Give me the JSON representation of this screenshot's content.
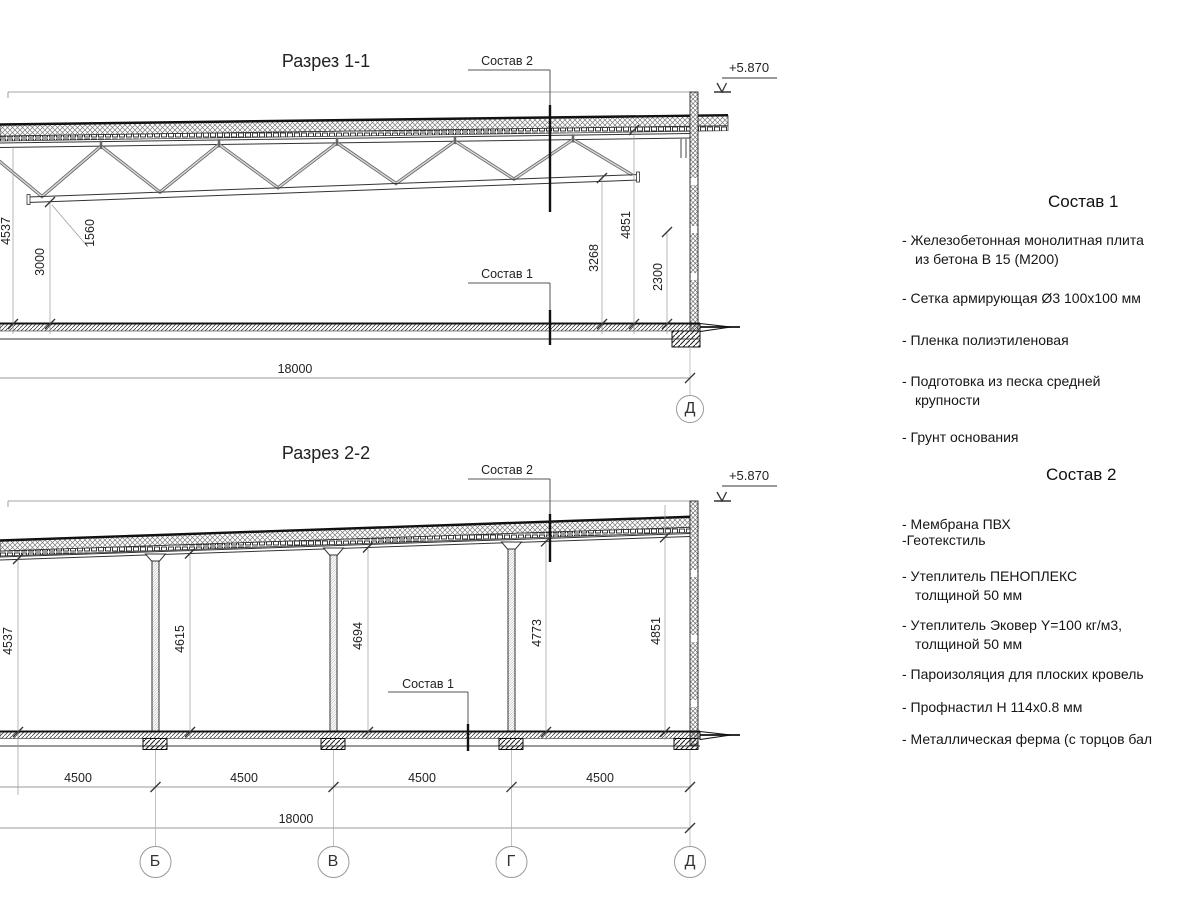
{
  "section_1": {
    "title": "Разрез 1-1",
    "composition_2_label": "Состав 2",
    "composition_1_label": "Состав 1",
    "elevation_mark": "+5.870",
    "dim_left_total": "4537",
    "dim_left_clear": "3000",
    "dim_truss_depth": "1560",
    "dim_right_roof": "4851",
    "dim_right_chord": "3268",
    "dim_right_panel": "2300",
    "dim_overall": "18000",
    "axis_label": "Д"
  },
  "section_2": {
    "title": "Разрез 2-2",
    "composition_2_label": "Состав 2",
    "composition_1_label": "Состав 1",
    "elevation_mark": "+5.870",
    "height_dims": [
      "4537",
      "4615",
      "4694",
      "4773",
      "4851"
    ],
    "bay_dims": [
      "4500",
      "4500",
      "4500",
      "4500"
    ],
    "dim_overall": "18000",
    "axis_labels": [
      "Б",
      "В",
      "Г",
      "Д"
    ]
  },
  "composition_1": {
    "heading": "Состав 1",
    "items": [
      {
        "line1": "- Железобетонная  монолитная плита",
        "line2": "из бетона В 15 (М200)"
      },
      {
        "line1": "- Сетка армирующая Ø3 100х100 мм",
        "line2": ""
      },
      {
        "line1": "- Пленка полиэтиленовая",
        "line2": ""
      },
      {
        "line1": "- Подготовка из песка средней",
        "line2": "крупности"
      },
      {
        "line1": "- Грунт основания",
        "line2": ""
      }
    ]
  },
  "composition_2": {
    "heading": "Состав 2",
    "items": [
      {
        "line1": "- Мембрана ПВХ",
        "line2": "-Геотекстиль"
      },
      {
        "line1": "- Утеплитель ПЕНОПЛЕКС",
        "line2": "толщиной 50 мм"
      },
      {
        "line1": "- Утеплитель Эковер Y=100 кг/м3,",
        "line2": "толщиной 50 мм"
      },
      {
        "line1": "- Пароизоляция для плоских кровель",
        "line2": ""
      },
      {
        "line1": "- Профнастил Н 114х0.8 мм",
        "line2": ""
      },
      {
        "line1": "- Металлическая ферма (с торцов бал",
        "line2": ""
      }
    ]
  }
}
